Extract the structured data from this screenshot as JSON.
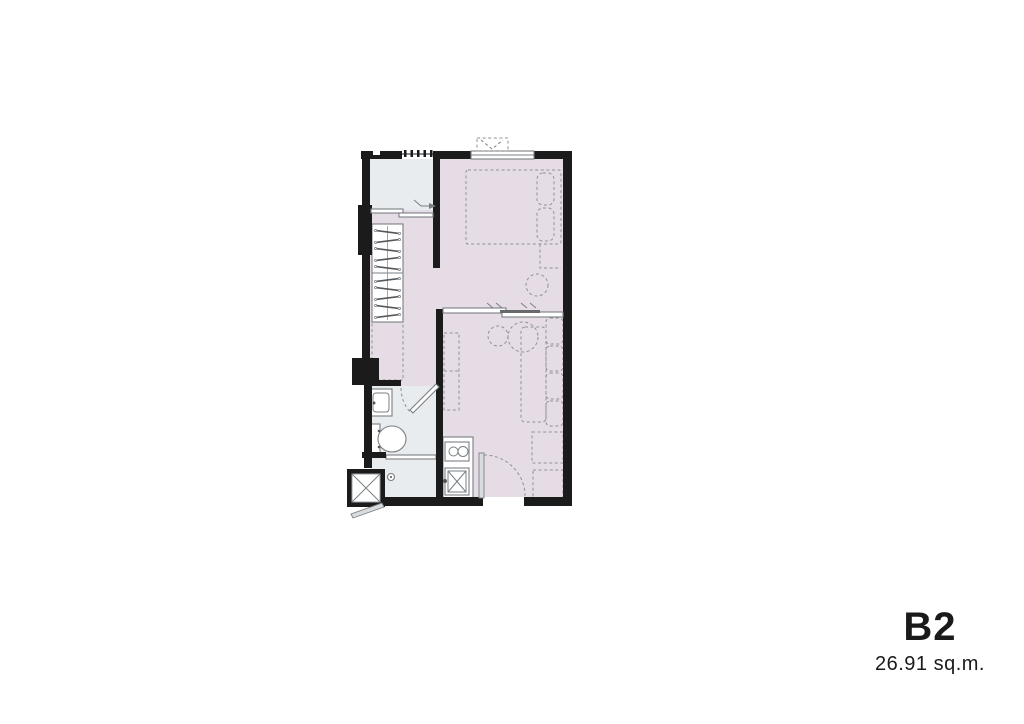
{
  "unit": {
    "code": "B2",
    "area": "26.91 sq.m."
  },
  "colors": {
    "background": "#ffffff",
    "wall": "#1b1b1b",
    "room-fill": "#e6dce5",
    "service-fill": "#e8ecee",
    "fixture-stroke": "#7a7f83",
    "furniture-stroke": "#8f9296",
    "text": "#1a1a1a"
  }
}
